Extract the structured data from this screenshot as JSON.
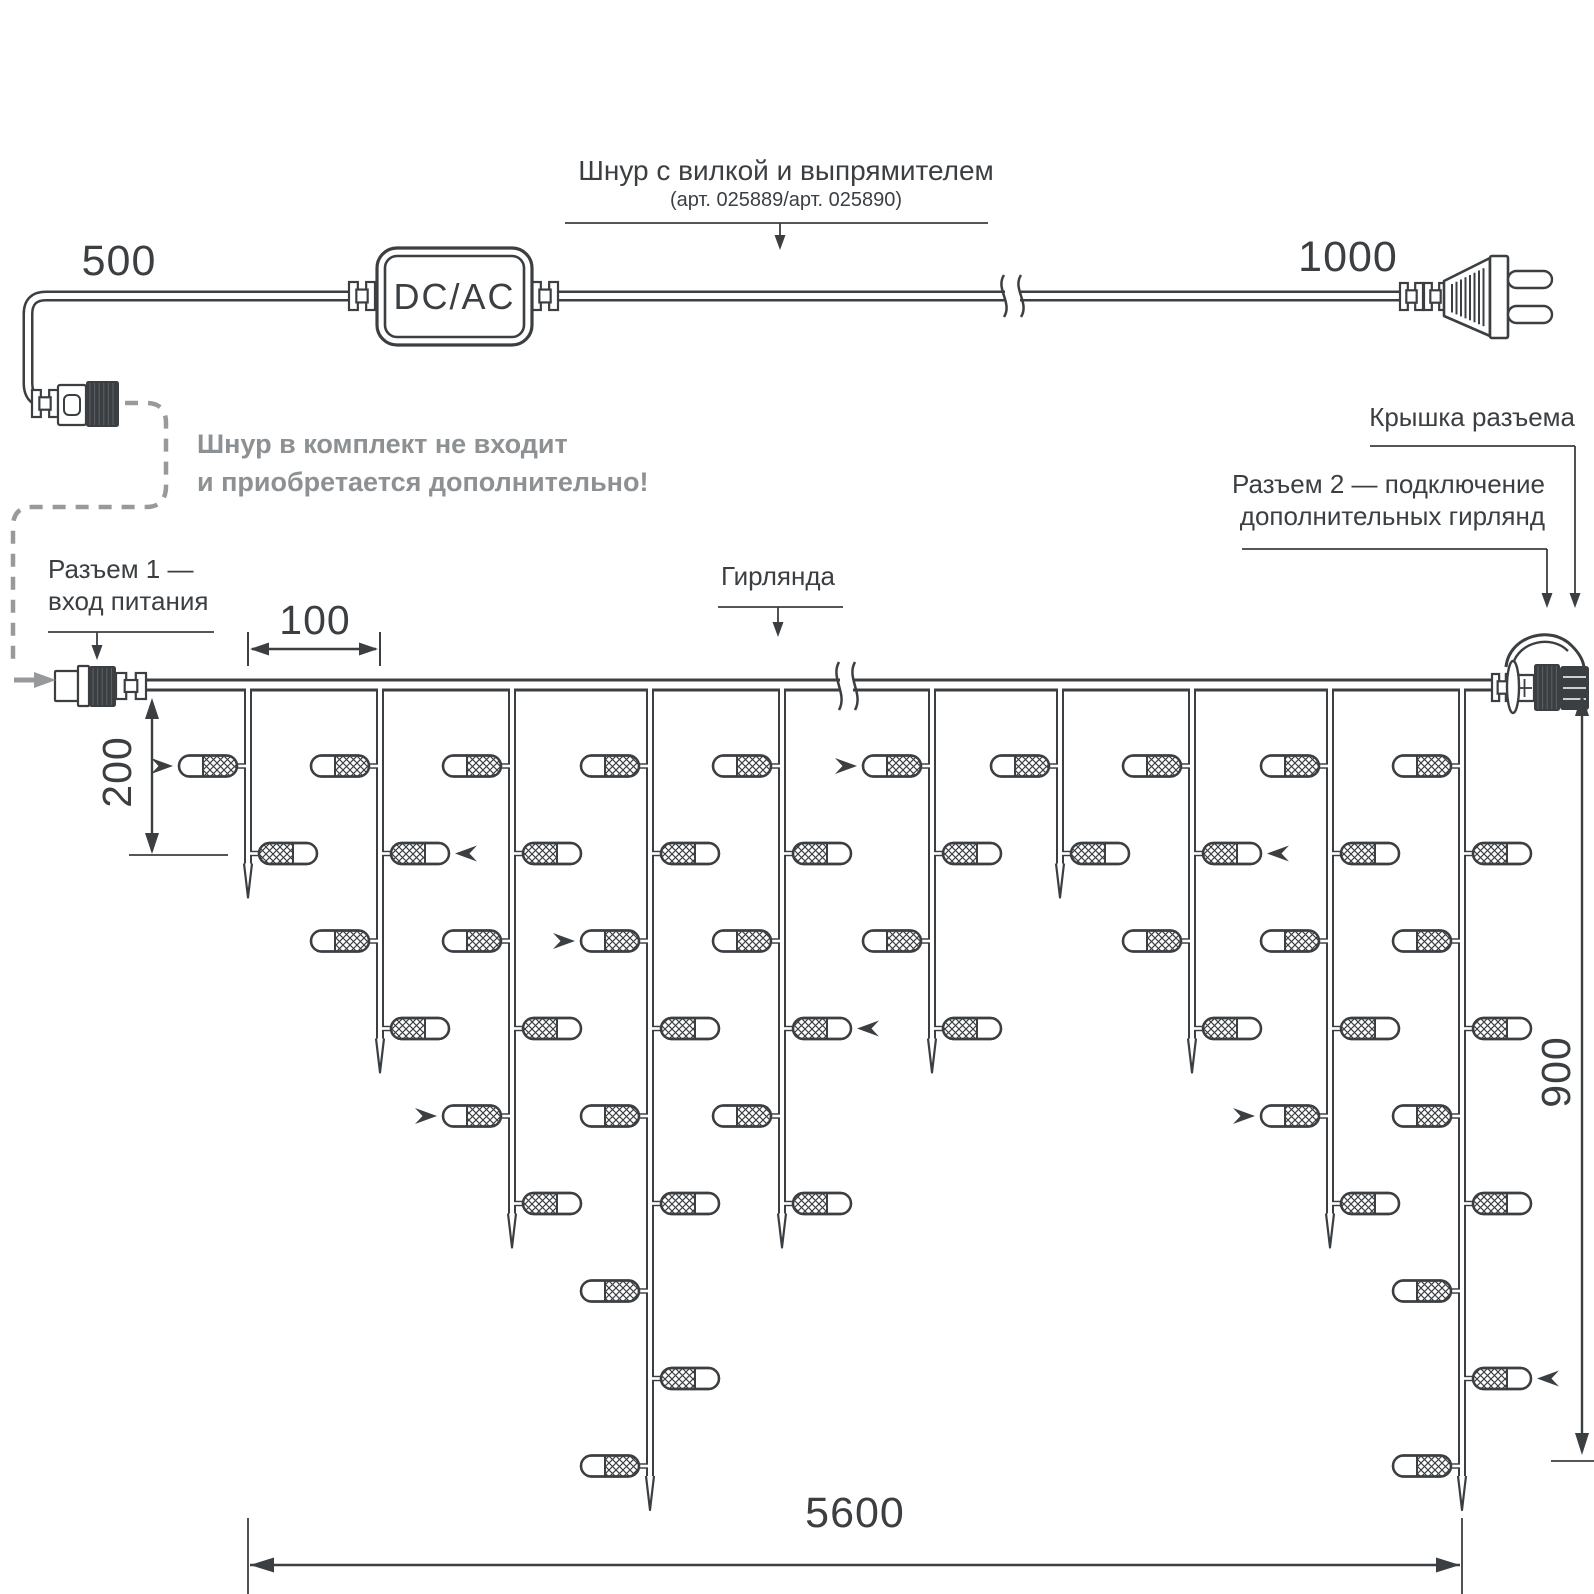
{
  "colors": {
    "line": "#3b3f42",
    "gray_text": "#8d9193",
    "gray_line": "#97999c",
    "background": "#ffffff"
  },
  "title": {
    "main": "Шнур с вилкой и выпрямителем",
    "sub": "(арт. 025889/арт. 025890)"
  },
  "converter": {
    "label": "DC/AC"
  },
  "note": {
    "line1": "Шнур в комплект не входит",
    "line2": "и приобретается дополнительно!"
  },
  "callouts": {
    "connector1_line1": "Разъем 1 —",
    "connector1_line2": "вход питания",
    "garland": "Гирлянда",
    "cap": "Крышка разъема",
    "connector2_line1": "Разъем 2 — подключение",
    "connector2_line2": "дополнительных гирлянд"
  },
  "dimensions": {
    "cord_to_connector_mm": "500",
    "cord_to_plug_mm": "1000",
    "drop_spacing_mm": "100",
    "bulb_spacing_mm": "200",
    "drop_max_height_mm": "900",
    "garland_length_mm": "5600"
  },
  "garland": {
    "drops": [
      {
        "bulbs": 2,
        "flash_bulb": 1
      },
      {
        "bulbs": 4,
        "flash_bulb": 2
      },
      {
        "bulbs": 6,
        "flash_bulb": 5
      },
      {
        "bulbs": 9,
        "flash_bulb": 3
      },
      {
        "bulbs": 6,
        "flash_bulb": 4
      },
      {
        "bulbs": 4,
        "flash_bulb": 1
      },
      {
        "bulbs": 2,
        "flash_bulb": null
      },
      {
        "bulbs": 4,
        "flash_bulb": 2
      },
      {
        "bulbs": 6,
        "flash_bulb": 5
      },
      {
        "bulbs": 9,
        "flash_bulb": 8
      }
    ]
  }
}
